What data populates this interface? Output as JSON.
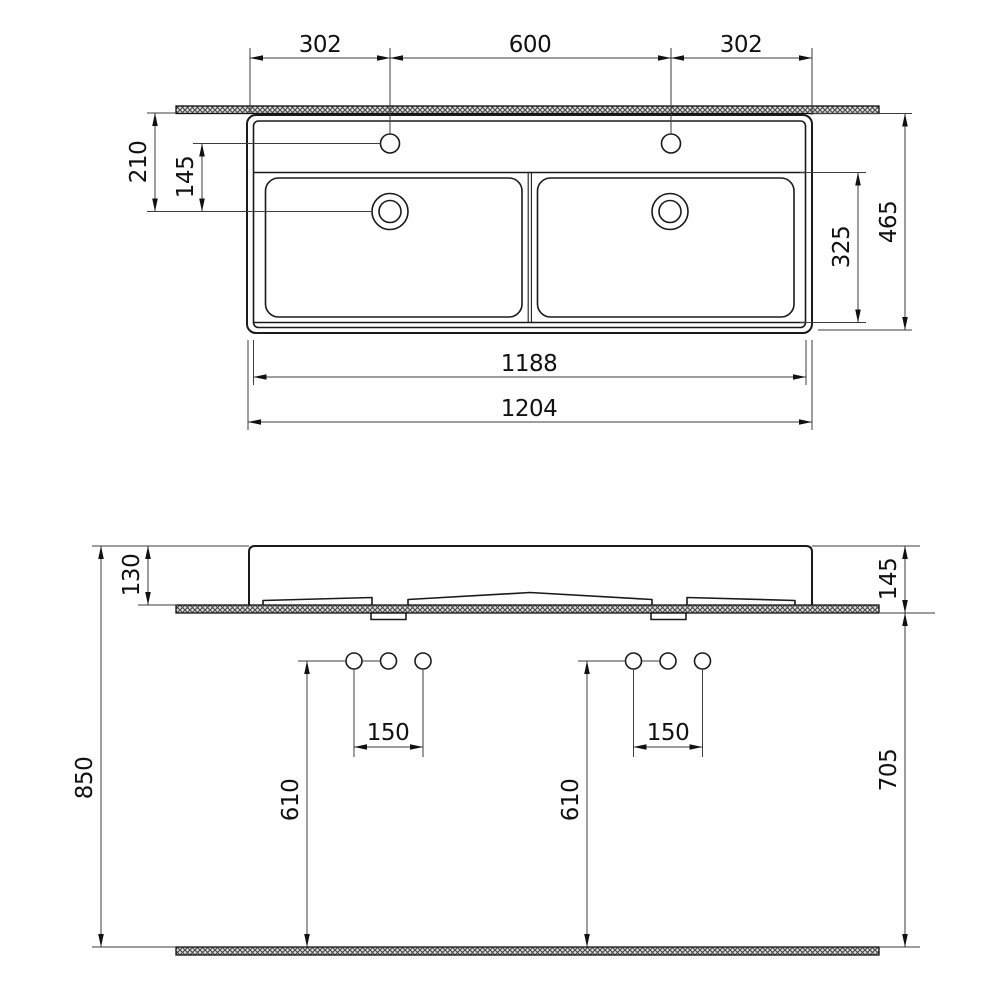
{
  "drawing_type": "washbasin-technical-drawing",
  "colors": {
    "object_line": "#1a1a1a",
    "dimension_line": "#3d3d3d",
    "text": "#111111",
    "hatch_line": "#4a4a4a",
    "hatch_background": "#dcdcdc",
    "background": "#ffffff"
  },
  "top_view": {
    "dim_hole_offset_left": "302",
    "dim_hole_spacing": "600",
    "dim_hole_offset_right": "302",
    "dim_drain_setback": "210",
    "dim_hole_to_drain": "145",
    "dim_total_depth": "465",
    "dim_basin_depth": "325",
    "dim_inner_width": "1188",
    "dim_total_width": "1204"
  },
  "front_view": {
    "dim_back_height": "130",
    "dim_front_height": "145",
    "dim_rim_to_floor": "850",
    "dim_supply_height_left": "610",
    "dim_supply_height_right": "610",
    "dim_supply_spacing_left": "150",
    "dim_supply_spacing_right": "150",
    "dim_under_rim_to_floor": "705"
  }
}
